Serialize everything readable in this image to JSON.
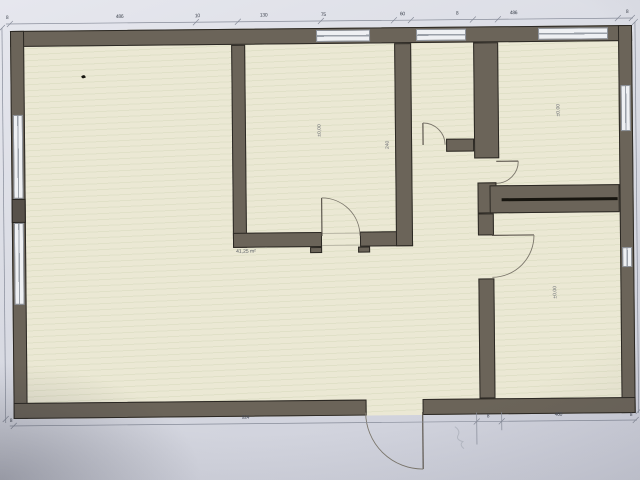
{
  "photo": {
    "subject": "architectural floor plan, photographed computer screen"
  },
  "colors": {
    "background": "#dadce4",
    "wall_fill": "#6b6459",
    "wall_outline": "#1c1915",
    "floor_fill": "#ebe8d4",
    "window_fill": "#eef0f3",
    "dimension_line": "#878c99",
    "label_text": "#6d7076"
  },
  "labels": {
    "room_middle": "±0,00",
    "hall_wall": "240",
    "room_right_top": "±0,00",
    "room_right_bottom": "±0,00",
    "big_room_area": "41,25 m²"
  },
  "dimensions": {
    "top": [
      "8",
      "486",
      "10",
      "130",
      "75",
      "60",
      "8",
      "486",
      "8"
    ],
    "bottom": [
      "8",
      "924",
      "8",
      "460",
      "8"
    ]
  }
}
